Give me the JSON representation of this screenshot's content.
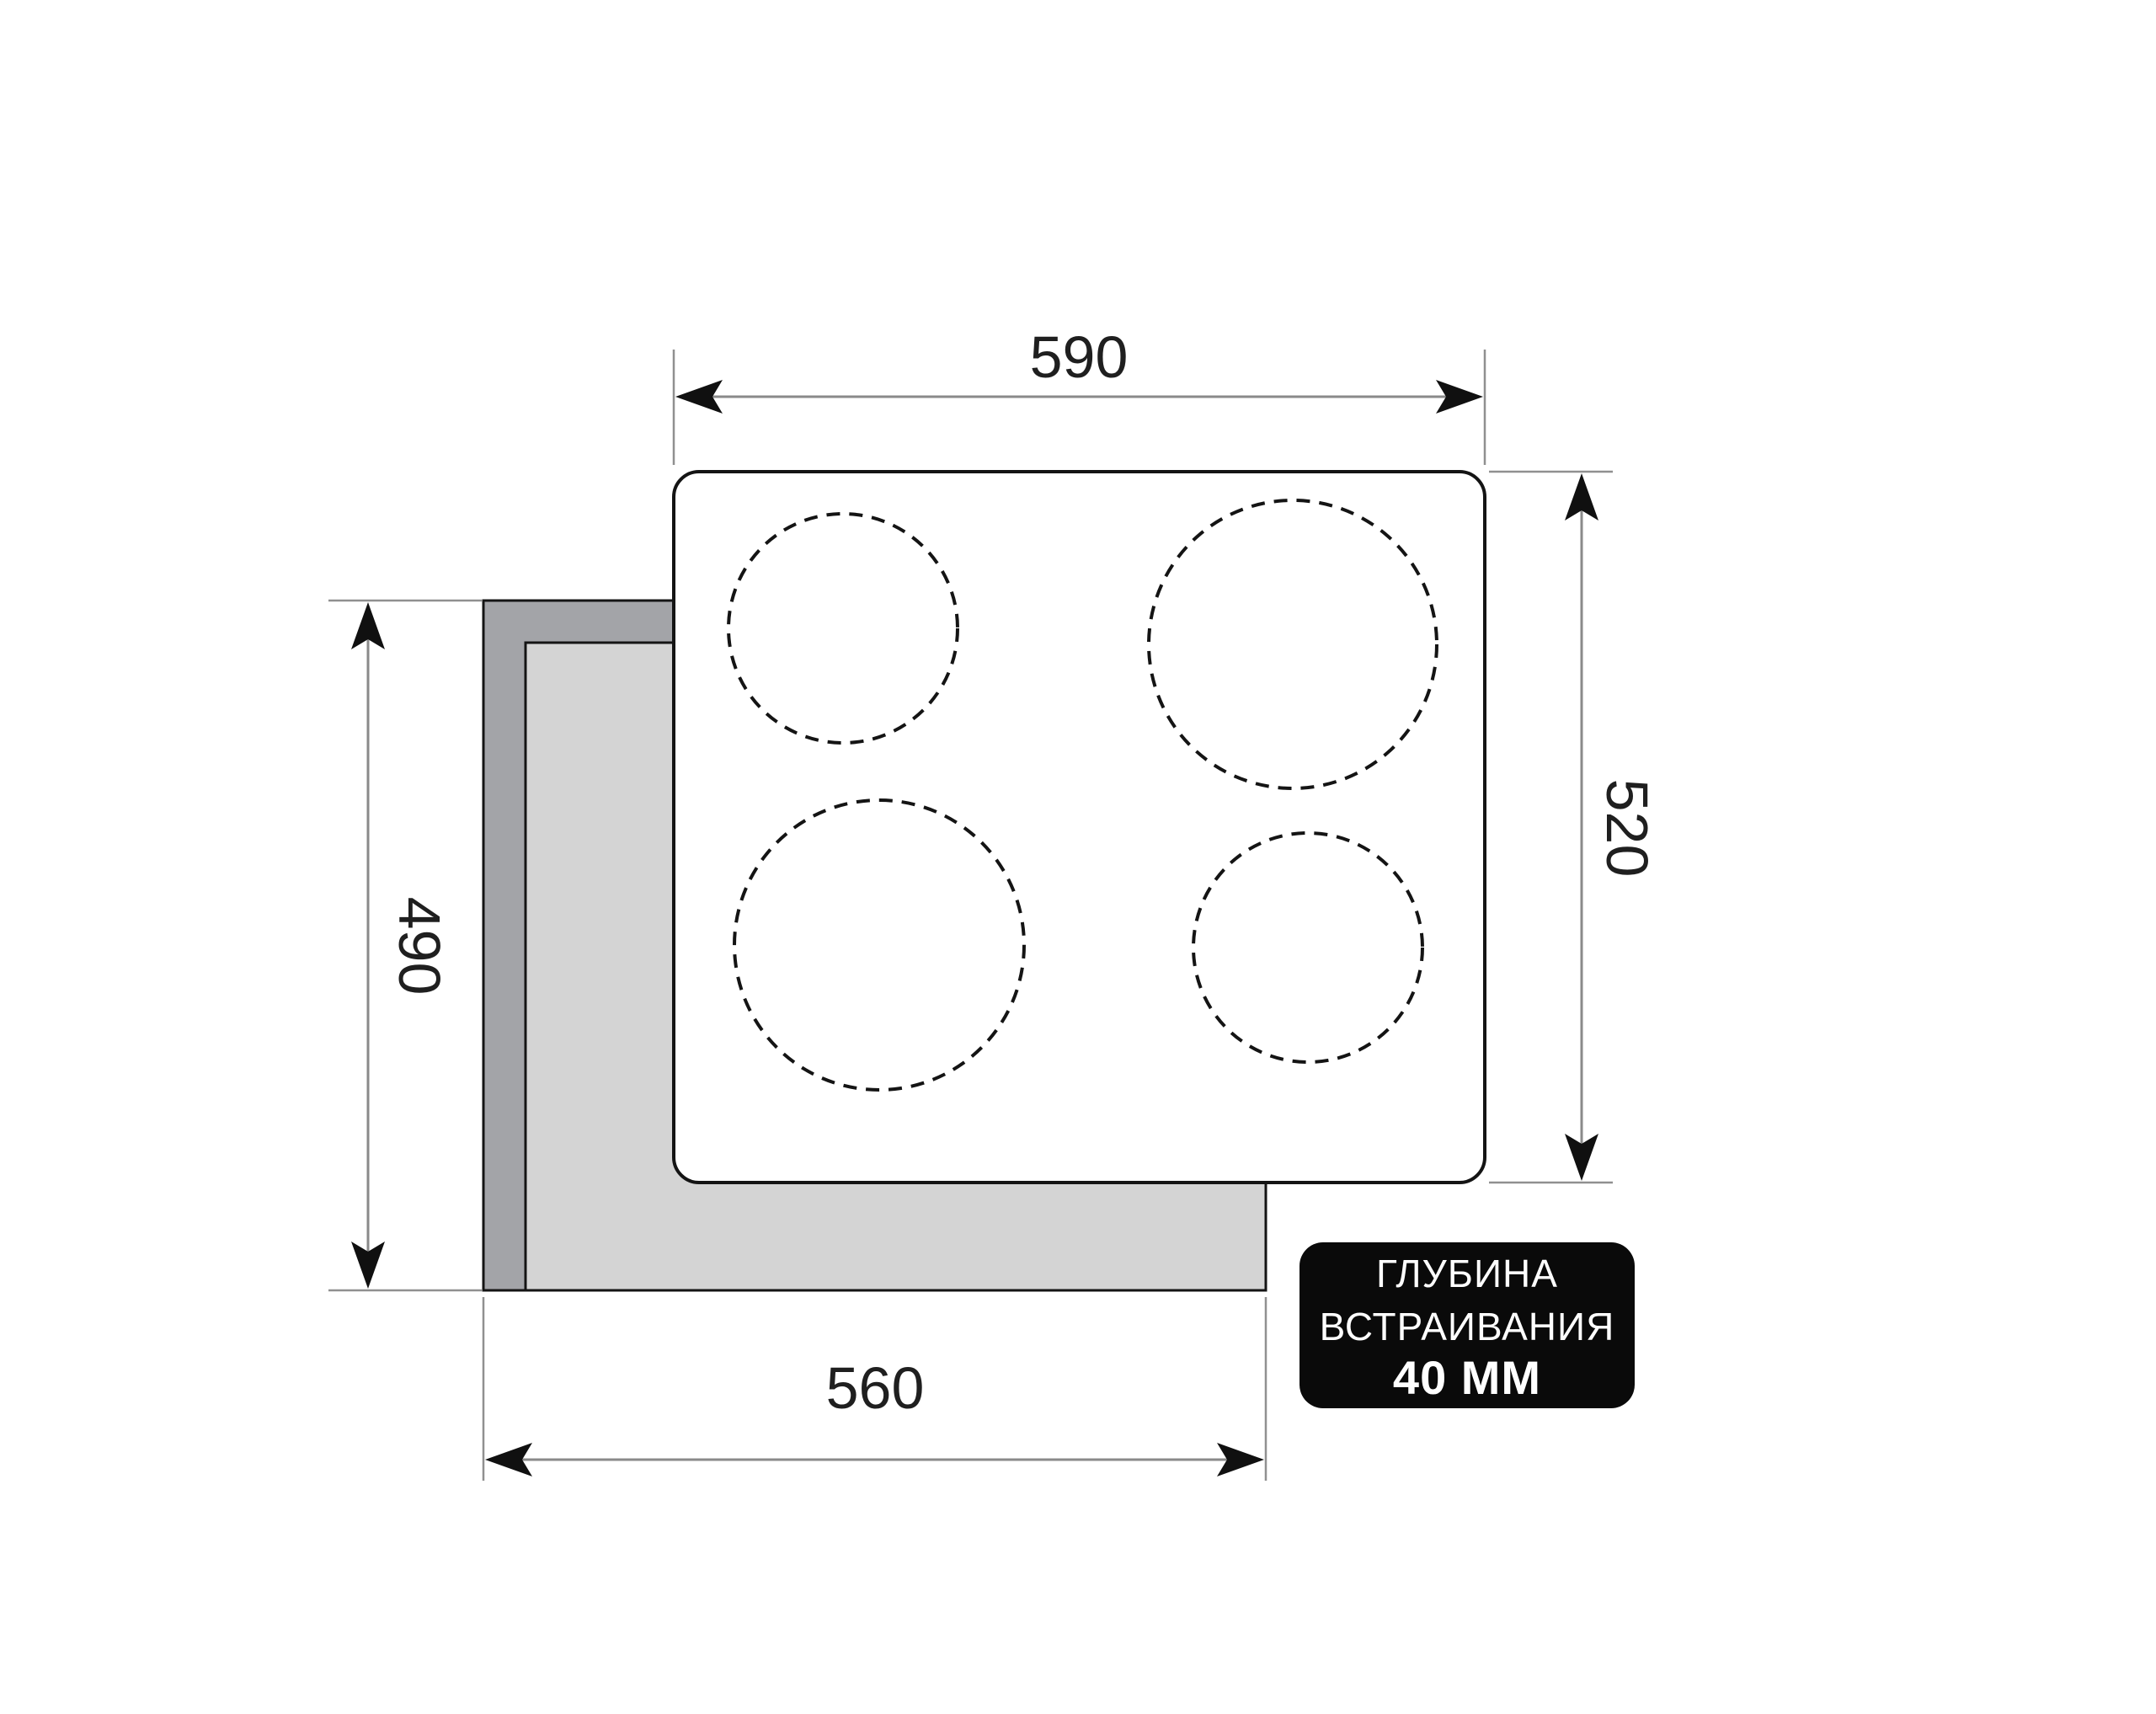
{
  "diagram": {
    "description": "Built-in hob installation dimensions drawing",
    "dimensions": {
      "hob_width": "590",
      "hob_depth": "520",
      "cutout_depth": "490",
      "cutout_width": "560"
    },
    "badge": {
      "line1": "ГЛУБИНА",
      "line2": "ВСТРАИВАНИЯ",
      "line3": "40 ММ"
    },
    "colors": {
      "background": "#ffffff",
      "outline": "#141414",
      "dim_line": "#8a8a8a",
      "counter_dark": "#a3a4a8",
      "counter_light": "#d4d4d4",
      "badge_bg": "#0a0a0a",
      "badge_text": "#ffffff"
    }
  }
}
